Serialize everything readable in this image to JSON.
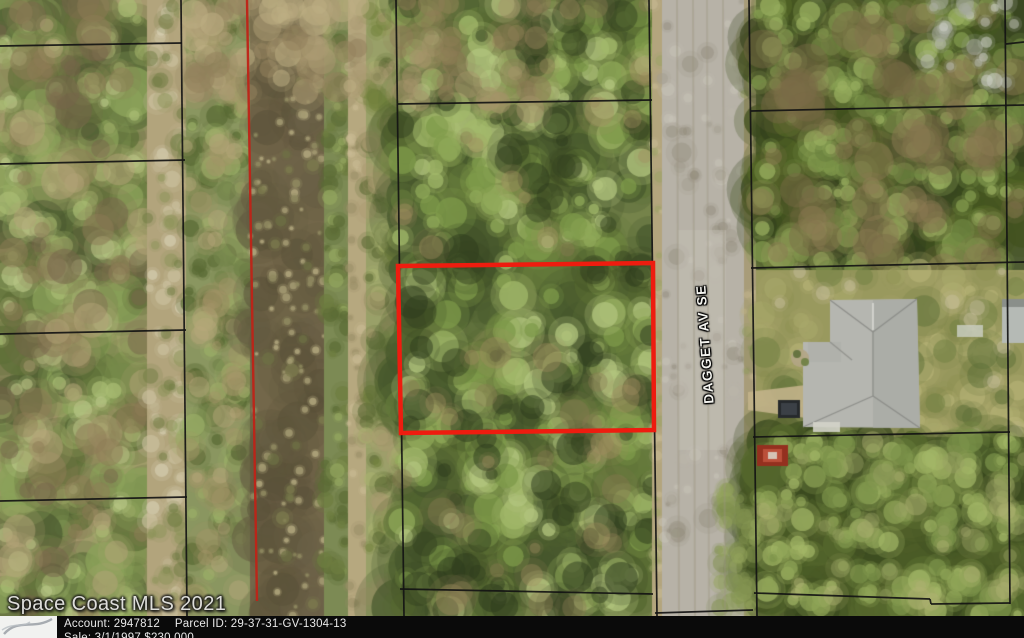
{
  "watermark": {
    "text": "Space Coast MLS 2021"
  },
  "street": {
    "label": "DAGGET AV SE"
  },
  "info_bar": {
    "account": "Account: 2947812",
    "parcel_id": "Parcel ID: 29-37-31-GV-1304-13",
    "sale": "Sale: 3/1/1997 $230,000"
  },
  "colors": {
    "highlight_red": "#ee1c0f",
    "easement_red": "#bf2318",
    "parcel_line": "#141414",
    "bar_bg": "#0a0a0a",
    "bar_text": "#e9e9e9",
    "road_gray": "#b7b2a7",
    "water_brown": "#73674a",
    "roof_gray": "#b5b6b0"
  },
  "overlay": {
    "line_width": 1.7,
    "highlight_points": "398,266 653,263 654,430 401,433",
    "highlight_width": 4.5,
    "easement_line": [
      247,
      0,
      257,
      601
    ],
    "easement_width": 2.4,
    "parcel_lines": [
      [
        0,
        46,
        182,
        43
      ],
      [
        0,
        164,
        185,
        160
      ],
      [
        0,
        334,
        186,
        330
      ],
      [
        0,
        501,
        187,
        497
      ],
      [
        181,
        0,
        187,
        616
      ],
      [
        396,
        0,
        404,
        616
      ],
      [
        649,
        0,
        657,
        616
      ],
      [
        398,
        104,
        652,
        100
      ],
      [
        400,
        589,
        653,
        594
      ],
      [
        749,
        0,
        757,
        616
      ],
      [
        751,
        111,
        1024,
        105
      ],
      [
        751,
        268,
        1024,
        262
      ],
      [
        1005,
        0,
        1010,
        604
      ],
      [
        1006,
        44,
        1024,
        42
      ],
      [
        753,
        437,
        1010,
        432
      ],
      [
        754,
        593,
        930,
        599
      ],
      [
        930,
        599,
        931,
        604
      ],
      [
        931,
        604,
        1010,
        603
      ],
      [
        655,
        613,
        753,
        610
      ]
    ]
  },
  "map_paint": {
    "seed": 1337,
    "zones": [
      {
        "n": "left-parcels",
        "x": 0,
        "y": 0,
        "w": 147,
        "h": 616,
        "base": "#a79a6f",
        "layers": [
          {
            "count": 230,
            "rmin": 8,
            "rmax": 26,
            "a": 0.75,
            "colors": [
              "#4d5c31",
              "#5f7038",
              "#76894a",
              "#8ba25a"
            ]
          },
          {
            "count": 130,
            "rmin": 4,
            "rmax": 12,
            "a": 0.7,
            "colors": [
              "#a9bc74",
              "#97a763",
              "#b7c585"
            ]
          },
          {
            "count": 90,
            "rmin": 6,
            "rmax": 20,
            "a": 0.5,
            "colors": [
              "#8d7b55",
              "#b3a478",
              "#75644a"
            ]
          }
        ]
      },
      {
        "n": "west-trail",
        "x": 147,
        "y": 0,
        "w": 39,
        "h": 616,
        "base": "#b2a47c",
        "layers": [
          {
            "count": 55,
            "rmin": 3,
            "rmax": 9,
            "a": 0.6,
            "colors": [
              "#cdc3a2",
              "#d9d2b6",
              "#c0b491"
            ]
          },
          {
            "count": 45,
            "rmin": 3,
            "rmax": 9,
            "a": 0.5,
            "colors": [
              "#8b9458",
              "#6f7c42"
            ]
          }
        ]
      },
      {
        "n": "canal-west-bank",
        "x": 186,
        "y": 0,
        "w": 64,
        "h": 616,
        "base": "#8a9660",
        "layers": [
          {
            "count": 150,
            "rmin": 4,
            "rmax": 12,
            "a": 0.7,
            "colors": [
              "#5a6b35",
              "#73854a",
              "#9aae66"
            ]
          },
          {
            "count": 60,
            "rmin": 4,
            "rmax": 14,
            "a": 0.45,
            "colors": [
              "#a59468",
              "#b7a87c"
            ]
          }
        ]
      },
      {
        "n": "canal-water",
        "x": 250,
        "y": 0,
        "w": 74,
        "h": 616,
        "base": "#73674a",
        "layers": [
          {
            "count": 90,
            "rmin": 8,
            "rmax": 24,
            "a": 0.5,
            "colors": [
              "#635940",
              "#584f38",
              "#6b6147"
            ]
          },
          {
            "count": 120,
            "rmin": 1.5,
            "rmax": 4,
            "a": 0.85,
            "colors": [
              "#a39a72",
              "#b0a67c",
              "#8f8a60"
            ]
          },
          {
            "count": 25,
            "rmin": 3,
            "rmax": 7,
            "a": 0.7,
            "colors": [
              "#7d7c4e",
              "#6e7044"
            ]
          }
        ]
      },
      {
        "n": "canal-east-bank",
        "x": 324,
        "y": 0,
        "w": 24,
        "h": 616,
        "base": "#7c8a54",
        "layers": [
          {
            "count": 80,
            "rmin": 3,
            "rmax": 9,
            "a": 0.7,
            "colors": [
              "#5c6c36",
              "#94a660",
              "#6d7d40"
            ]
          }
        ]
      },
      {
        "n": "canal-east-path",
        "x": 348,
        "y": 0,
        "w": 18,
        "h": 616,
        "base": "#b6a87f",
        "layers": [
          {
            "count": 40,
            "rmin": 2,
            "rmax": 6,
            "a": 0.6,
            "colors": [
              "#cabb94",
              "#9b8f68"
            ]
          }
        ]
      },
      {
        "n": "east-verge",
        "x": 366,
        "y": 0,
        "w": 34,
        "h": 616,
        "base": "#99a068",
        "layers": [
          {
            "count": 90,
            "rmin": 4,
            "rmax": 10,
            "a": 0.6,
            "colors": [
              "#75833f",
              "#5d6b36",
              "#aab26f"
            ]
          },
          {
            "count": 40,
            "rmin": 4,
            "rmax": 10,
            "a": 0.45,
            "colors": [
              "#ab9b70"
            ]
          }
        ]
      },
      {
        "n": "middle-parcel",
        "x": 400,
        "y": 0,
        "w": 252,
        "h": 616,
        "base": "#75834a",
        "layers": [
          {
            "count": 260,
            "rmin": 10,
            "rmax": 30,
            "a": 0.7,
            "colors": [
              "#46572c",
              "#556831",
              "#64793a"
            ]
          },
          {
            "count": 270,
            "rmin": 5,
            "rmax": 16,
            "a": 0.75,
            "colors": [
              "#7d9a4a",
              "#8fa858",
              "#a2b86a",
              "#b2c47d"
            ]
          },
          {
            "count": 80,
            "rmin": 6,
            "rmax": 18,
            "a": 0.5,
            "colors": [
              "#33411f",
              "#2c3a1c"
            ]
          },
          {
            "count": 60,
            "rmin": 5,
            "rmax": 16,
            "a": 0.4,
            "colors": [
              "#8a7a52",
              "#a08d60"
            ]
          }
        ]
      },
      {
        "n": "road-west-shoulder",
        "x": 652,
        "y": 0,
        "w": 10,
        "h": 616,
        "base": "#b3a57d",
        "layers": [
          {
            "count": 40,
            "rmin": 2,
            "rmax": 6,
            "a": 0.5,
            "colors": [
              "#9aa264",
              "#c9bc95"
            ]
          }
        ]
      },
      {
        "n": "road",
        "x": 662,
        "y": 0,
        "w": 82,
        "h": 616,
        "base": "#b7b2a7",
        "layers": [
          {
            "count": 70,
            "rmin": 2,
            "rmax": 7,
            "a": 0.5,
            "colors": [
              "#a49e90",
              "#c8c3b8",
              "#938d7f"
            ]
          },
          {
            "count": 25,
            "rmin": 4,
            "rmax": 10,
            "a": 0.35,
            "colors": [
              "#8d8776",
              "#bdb7ab"
            ]
          }
        ]
      },
      {
        "n": "road-east-shoulder",
        "x": 744,
        "y": 0,
        "w": 12,
        "h": 616,
        "base": "#a89c79",
        "layers": [
          {
            "count": 35,
            "rmin": 2,
            "rmax": 6,
            "a": 0.5,
            "colors": [
              "#8f9a5e",
              "#c2b38c"
            ]
          }
        ]
      },
      {
        "n": "right-top-trees",
        "x": 756,
        "y": 0,
        "w": 268,
        "h": 270,
        "base": "#4f5c33",
        "layers": [
          {
            "count": 240,
            "rmin": 8,
            "rmax": 24,
            "a": 0.75,
            "colors": [
              "#35431e",
              "#41521f",
              "#526426"
            ]
          },
          {
            "count": 200,
            "rmin": 4,
            "rmax": 12,
            "a": 0.75,
            "colors": [
              "#6d8440",
              "#82994d",
              "#98ae5f"
            ]
          },
          {
            "count": 60,
            "rmin": 8,
            "rmax": 20,
            "a": 0.45,
            "colors": [
              "#7b6b46",
              "#8d7c55"
            ]
          }
        ]
      },
      {
        "n": "house-lawn",
        "x": 756,
        "y": 270,
        "w": 268,
        "h": 167,
        "base": "#99995e",
        "layers": [
          {
            "count": 90,
            "rmin": 5,
            "rmax": 14,
            "a": 0.55,
            "colors": [
              "#aaa96c",
              "#8f9154",
              "#b9b77a"
            ]
          },
          {
            "count": 26,
            "rmin": 6,
            "rmax": 16,
            "a": 0.5,
            "colors": [
              "#6f7f42",
              "#5e7038"
            ]
          },
          {
            "count": 18,
            "rmin": 3,
            "rmax": 8,
            "a": 0.45,
            "colors": [
              "#c9c0a0"
            ]
          }
        ]
      },
      {
        "n": "right-bottom-trees",
        "x": 756,
        "y": 437,
        "w": 268,
        "h": 179,
        "base": "#626f3c",
        "layers": [
          {
            "count": 200,
            "rmin": 8,
            "rmax": 26,
            "a": 0.75,
            "colors": [
              "#3a481f",
              "#4a5a26",
              "#56682e"
            ]
          },
          {
            "count": 150,
            "rmin": 4,
            "rmax": 12,
            "a": 0.7,
            "colors": [
              "#7c934a",
              "#8fa457",
              "#a3b766"
            ]
          },
          {
            "count": 40,
            "rmin": 5,
            "rmax": 12,
            "a": 0.45,
            "colors": [
              "#97a061",
              "#b0b274"
            ]
          }
        ]
      },
      {
        "n": "canal-top-dirt",
        "x": 186,
        "y": 0,
        "w": 180,
        "h": 95,
        "layers": [
          {
            "count": 60,
            "rmin": 6,
            "rmax": 16,
            "a": 0.55,
            "colors": [
              "#ab9b72",
              "#bdae84",
              "#93825c"
            ]
          }
        ]
      },
      {
        "n": "mid-top-dirt",
        "x": 400,
        "y": 0,
        "w": 140,
        "h": 110,
        "layers": [
          {
            "count": 28,
            "rmin": 6,
            "rmax": 14,
            "a": 0.5,
            "colors": [
              "#8d7c55",
              "#a5936a"
            ]
          }
        ]
      },
      {
        "n": "gray-dead-trees",
        "x": 925,
        "y": 0,
        "w": 95,
        "h": 95,
        "layers": [
          {
            "count": 24,
            "rmin": 3,
            "rmax": 9,
            "a": 0.55,
            "colors": [
              "#b9bcb0",
              "#cdd0c6",
              "#a6aa9c"
            ]
          }
        ]
      },
      {
        "n": "road-lower-grass",
        "x": 716,
        "y": 480,
        "w": 40,
        "h": 130,
        "layers": [
          {
            "count": 40,
            "rmin": 4,
            "rmax": 10,
            "a": 0.5,
            "colors": [
              "#7f8f4e",
              "#93a35c"
            ]
          }
        ]
      }
    ],
    "features": [
      {
        "t": "rect",
        "r": [
          678,
          230,
          48,
          220
        ],
        "c": "#c6c1b5",
        "a": 0.45
      },
      {
        "t": "line",
        "p": [
          677,
          0,
          679,
          616
        ],
        "c": "#9a9480",
        "w": 2,
        "a": 0.4
      },
      {
        "t": "line",
        "p": [
          693,
          0,
          695,
          616
        ],
        "c": "#9a9480",
        "w": 2,
        "a": 0.4
      },
      {
        "t": "line",
        "p": [
          707,
          0,
          709,
          616
        ],
        "c": "#9a9480",
        "w": 2,
        "a": 0.35
      },
      {
        "t": "line",
        "p": [
          723,
          0,
          725,
          616
        ],
        "c": "#9a9480",
        "w": 2,
        "a": 0.4
      },
      {
        "t": "poly",
        "pts": [
          [
            748,
            392
          ],
          [
            806,
            385
          ],
          [
            806,
            418
          ],
          [
            748,
            410
          ]
        ],
        "c": "#c2b389",
        "a": 0.9
      },
      {
        "t": "poly",
        "pts": [
          [
            830,
            300
          ],
          [
            917,
            299
          ],
          [
            920,
            428
          ],
          [
            803,
            427
          ],
          [
            803,
            342
          ],
          [
            830,
            342
          ]
        ],
        "c": "#b5b6b0",
        "a": 1
      },
      {
        "t": "rect",
        "r": [
          808,
          342,
          33,
          20
        ],
        "c": "#b0b1ab",
        "a": 1
      },
      {
        "t": "poly",
        "pts": [
          [
            873,
            300
          ],
          [
            917,
            299
          ],
          [
            920,
            428
          ],
          [
            873,
            428
          ]
        ],
        "c": "#a8a9a4",
        "a": 0.75
      },
      {
        "t": "line",
        "p": [
          830,
          300,
          873,
          332
        ],
        "c": "#8a8b86",
        "w": 1.3,
        "a": 0.9
      },
      {
        "t": "line",
        "p": [
          917,
          299,
          873,
          332
        ],
        "c": "#8a8b86",
        "w": 1.3,
        "a": 0.9
      },
      {
        "t": "line",
        "p": [
          873,
          332,
          873,
          396
        ],
        "c": "#8a8b86",
        "w": 1.3,
        "a": 0.9
      },
      {
        "t": "line",
        "p": [
          873,
          396,
          803,
          427
        ],
        "c": "#8a8b86",
        "w": 1.3,
        "a": 0.9
      },
      {
        "t": "line",
        "p": [
          873,
          396,
          920,
          428
        ],
        "c": "#8a8b86",
        "w": 1.3,
        "a": 0.9
      },
      {
        "t": "line",
        "p": [
          830,
          342,
          852,
          360
        ],
        "c": "#8a8b86",
        "w": 1.2,
        "a": 0.8
      },
      {
        "t": "line",
        "p": [
          873,
          303,
          873,
          330
        ],
        "c": "#e6e7e2",
        "w": 1.5,
        "a": 0.8
      },
      {
        "t": "dot",
        "p": [
          800,
          358
        ],
        "r": 9,
        "c": "#b3a585",
        "a": 0.9
      },
      {
        "t": "dot",
        "p": [
          797,
          354
        ],
        "r": 4,
        "c": "#5e6f3a",
        "a": 0.9
      },
      {
        "t": "dot",
        "p": [
          805,
          362
        ],
        "r": 4,
        "c": "#6d7f43",
        "a": 0.9
      },
      {
        "t": "rect",
        "r": [
          778,
          400,
          22,
          18
        ],
        "c": "#26292c",
        "a": 1
      },
      {
        "t": "rect",
        "r": [
          781,
          403,
          16,
          12
        ],
        "c": "#3b4046",
        "a": 1
      },
      {
        "t": "rect",
        "r": [
          757,
          445,
          31,
          21
        ],
        "c": "#94301f",
        "a": 1
      },
      {
        "t": "rect",
        "r": [
          763,
          449,
          19,
          13
        ],
        "c": "#bb4f3a",
        "a": 1
      },
      {
        "t": "rect",
        "r": [
          768,
          452,
          9,
          7
        ],
        "c": "#d8cfc4",
        "a": 0.9
      },
      {
        "t": "rect",
        "r": [
          813,
          422,
          27,
          10
        ],
        "c": "#d3d3c9",
        "a": 0.9
      },
      {
        "t": "rect",
        "r": [
          1002,
          299,
          22,
          44
        ],
        "c": "#b5bab5",
        "a": 1
      },
      {
        "t": "rect",
        "r": [
          1002,
          299,
          22,
          8
        ],
        "c": "#8a8f8a",
        "a": 1
      },
      {
        "t": "rect",
        "r": [
          957,
          325,
          26,
          12
        ],
        "c": "#cdd1c5",
        "a": 0.8
      }
    ]
  }
}
